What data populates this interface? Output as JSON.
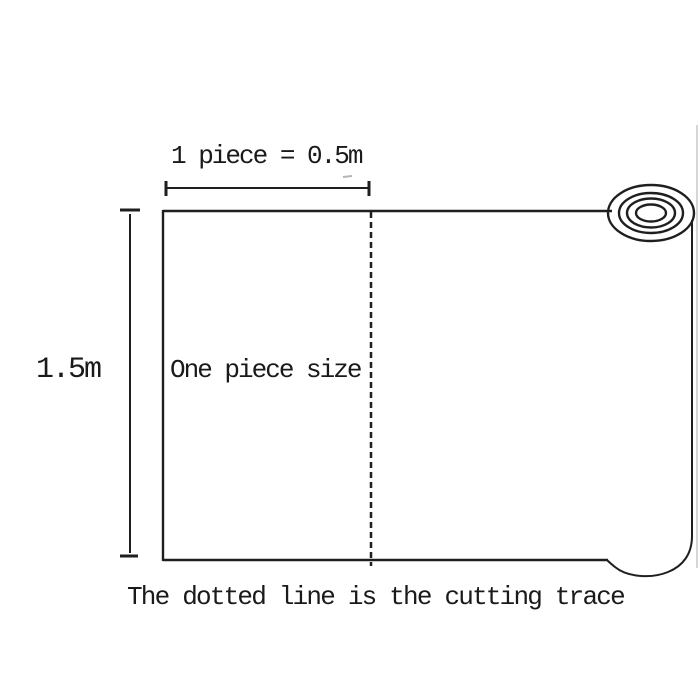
{
  "diagram": {
    "top_dimension_label": "1 piece = 0.5m",
    "left_dimension_label": "1.5m",
    "piece_label": "One piece size",
    "caption": "The dotted line is the cutting trace"
  },
  "colors": {
    "background": "#ffffff",
    "line": "#1f1f1f",
    "text": "#1a1a1a"
  }
}
